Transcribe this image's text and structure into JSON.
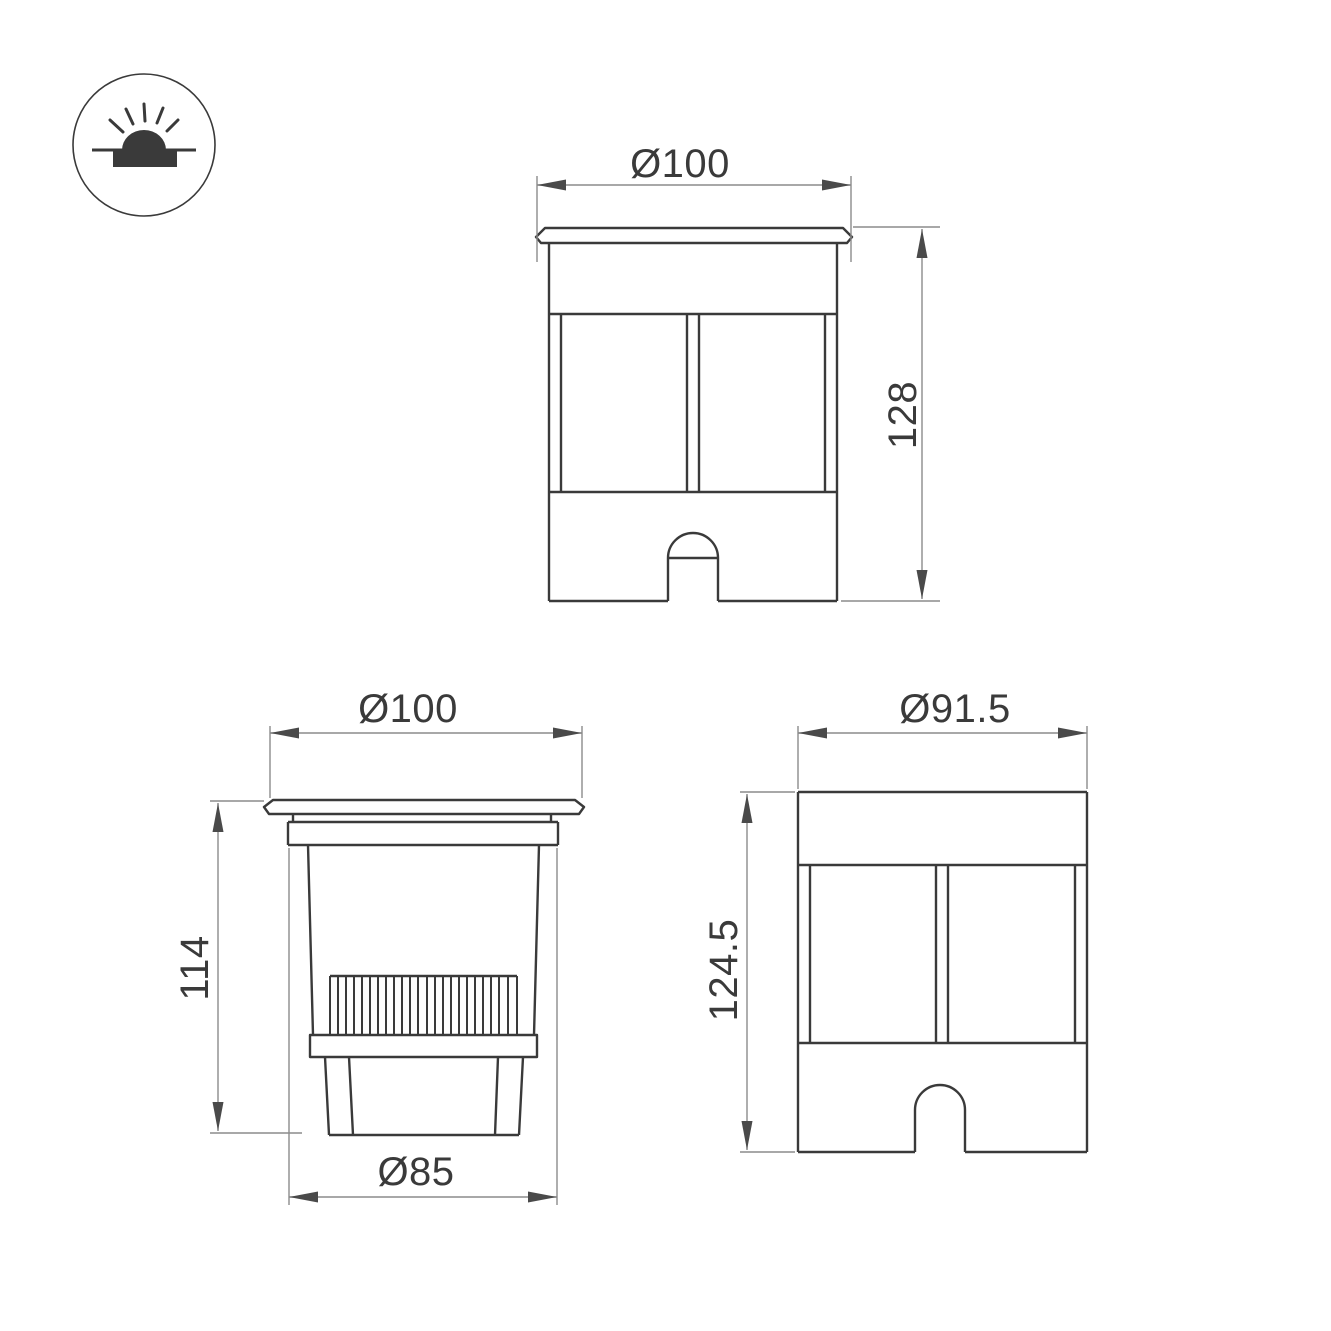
{
  "drawing": {
    "background": "#ffffff",
    "object_line_color": "#3a3a3a",
    "dimension_line_color": "#8c8c8c",
    "arrow_color": "#4a4a4a",
    "text_color": "#3a3a3a",
    "icon": {
      "name": "recessed-ground-light-icon",
      "meaning": "recessed in-ground luminaire, light emitted upward"
    },
    "views": {
      "front": {
        "diameter": "Ø100",
        "height": "128"
      },
      "section": {
        "diameter": "Ø100",
        "height": "114",
        "base_diameter": "Ø85"
      },
      "side": {
        "diameter": "Ø91.5",
        "height": "124.5"
      }
    }
  }
}
